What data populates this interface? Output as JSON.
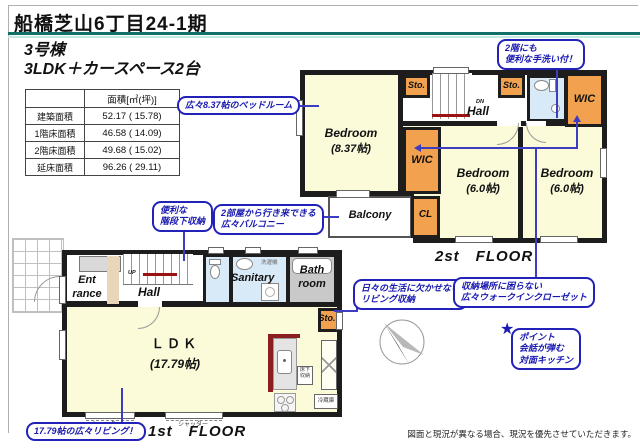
{
  "header": {
    "title": "船橋芝山6丁目24-1期",
    "unit": "3号棟",
    "layout": "3LDK＋カースペース2台"
  },
  "area_table": {
    "header_label": "面積[㎡(坪)]",
    "rows": [
      {
        "label": "建築面積",
        "value": "52.17 ( 15.78)"
      },
      {
        "label": "1階床面積",
        "value": "46.58 ( 14.09)"
      },
      {
        "label": "2階床面積",
        "value": "49.68 ( 15.02)"
      },
      {
        "label": "延床面積",
        "value": "96.26 ( 29.11)"
      }
    ]
  },
  "floor2": {
    "floor_label": "2st　FLOOR",
    "bedroom_main": "Bedroom",
    "bedroom_main_size": "(8.37帖)",
    "bedroom_center": "Bedroom",
    "bedroom_center_size": "(6.0帖)",
    "bedroom_right": "Bedroom",
    "bedroom_right_size": "(6.0帖)",
    "hall": "Hall",
    "dn": "DN",
    "sto1": "Sto.",
    "sto2": "Sto.",
    "wic_right": "WIC",
    "wic_mid": "WIC",
    "cl": "CL",
    "balcony": "Balcony"
  },
  "floor1": {
    "floor_label": "1st　FLOOR",
    "entrance": "Ent\nrance",
    "hall": "Hall",
    "up": "UP",
    "sanitary": "Sanitary",
    "laundry": "洗濯機",
    "bath": "Bath\nroom",
    "sto": "Sto.",
    "ldk": "ＬＤＫ",
    "ldk_size": "(17.79帖)",
    "underfloor": "床下\n収納",
    "fridge": "冷蔵庫",
    "shutter": "シャッター"
  },
  "callouts": {
    "bedroom_main": "広々8.37帖のベッドルーム",
    "handwash": "2階にも\n便利な手洗い付！",
    "stair_storage": "便利な\n階段下収納",
    "balcony": "2部屋から行き来できる\n広々バルコニー",
    "living_storage": "日々の生活に欠かせない\nリビング収納",
    "wic": "収納場所に困らない\n広々ウォークインクローゼット",
    "point_star": "★",
    "point": "ポイント\n会話が弾む\n対面キッチン",
    "living": "17.79帖の広々リビング！"
  },
  "footer": {
    "disclaimer": "図面と現況が異なる場合、現況を優先させていただきます。"
  },
  "colors": {
    "accent_teal": "#117068",
    "accent_teal_light": "#c4e8e3",
    "callout_blue": "#2222b8",
    "line_blue": "#3d3dc2",
    "room_orange": "#f2a24e",
    "room_blue": "#d8e9f7",
    "room_yellow": "#fbfad9",
    "bath_gray": "#c9c9c9",
    "wall_black": "#1d1d1d",
    "stair_red": "#991111",
    "counter_red": "#8b1e1e"
  }
}
